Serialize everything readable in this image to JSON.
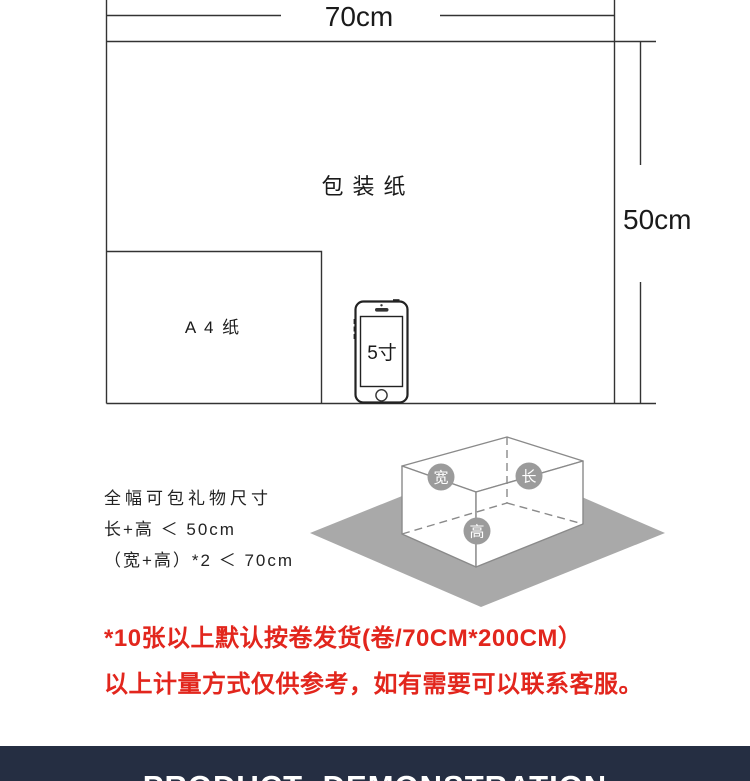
{
  "diagram": {
    "width_dim": "70cm",
    "height_dim": "50cm",
    "paper_label": "包装纸",
    "a4_label": "A 4 纸",
    "phone_label": "5寸"
  },
  "box": {
    "width_badge": "宽",
    "length_badge": "长",
    "height_badge": "高"
  },
  "size_note": {
    "title": "全幅可包礼物尺寸",
    "rule1": "长+高 ＜ 50cm",
    "rule2": "（宽+高）*2 ＜ 70cm"
  },
  "notice": {
    "line1": "*10张以上默认按卷发货(卷/70CM*200CM）",
    "line2": "以上计量方式仅供参考，如有需要可以联系客服。"
  },
  "footer": {
    "title": "PRODUCT DEMONSTRATION"
  },
  "colors": {
    "notice_red": "#e2261d",
    "footer_navy": "#252e42",
    "diamond_gray": "#a9a9a9",
    "badge_gray": "#9b9b9b"
  }
}
